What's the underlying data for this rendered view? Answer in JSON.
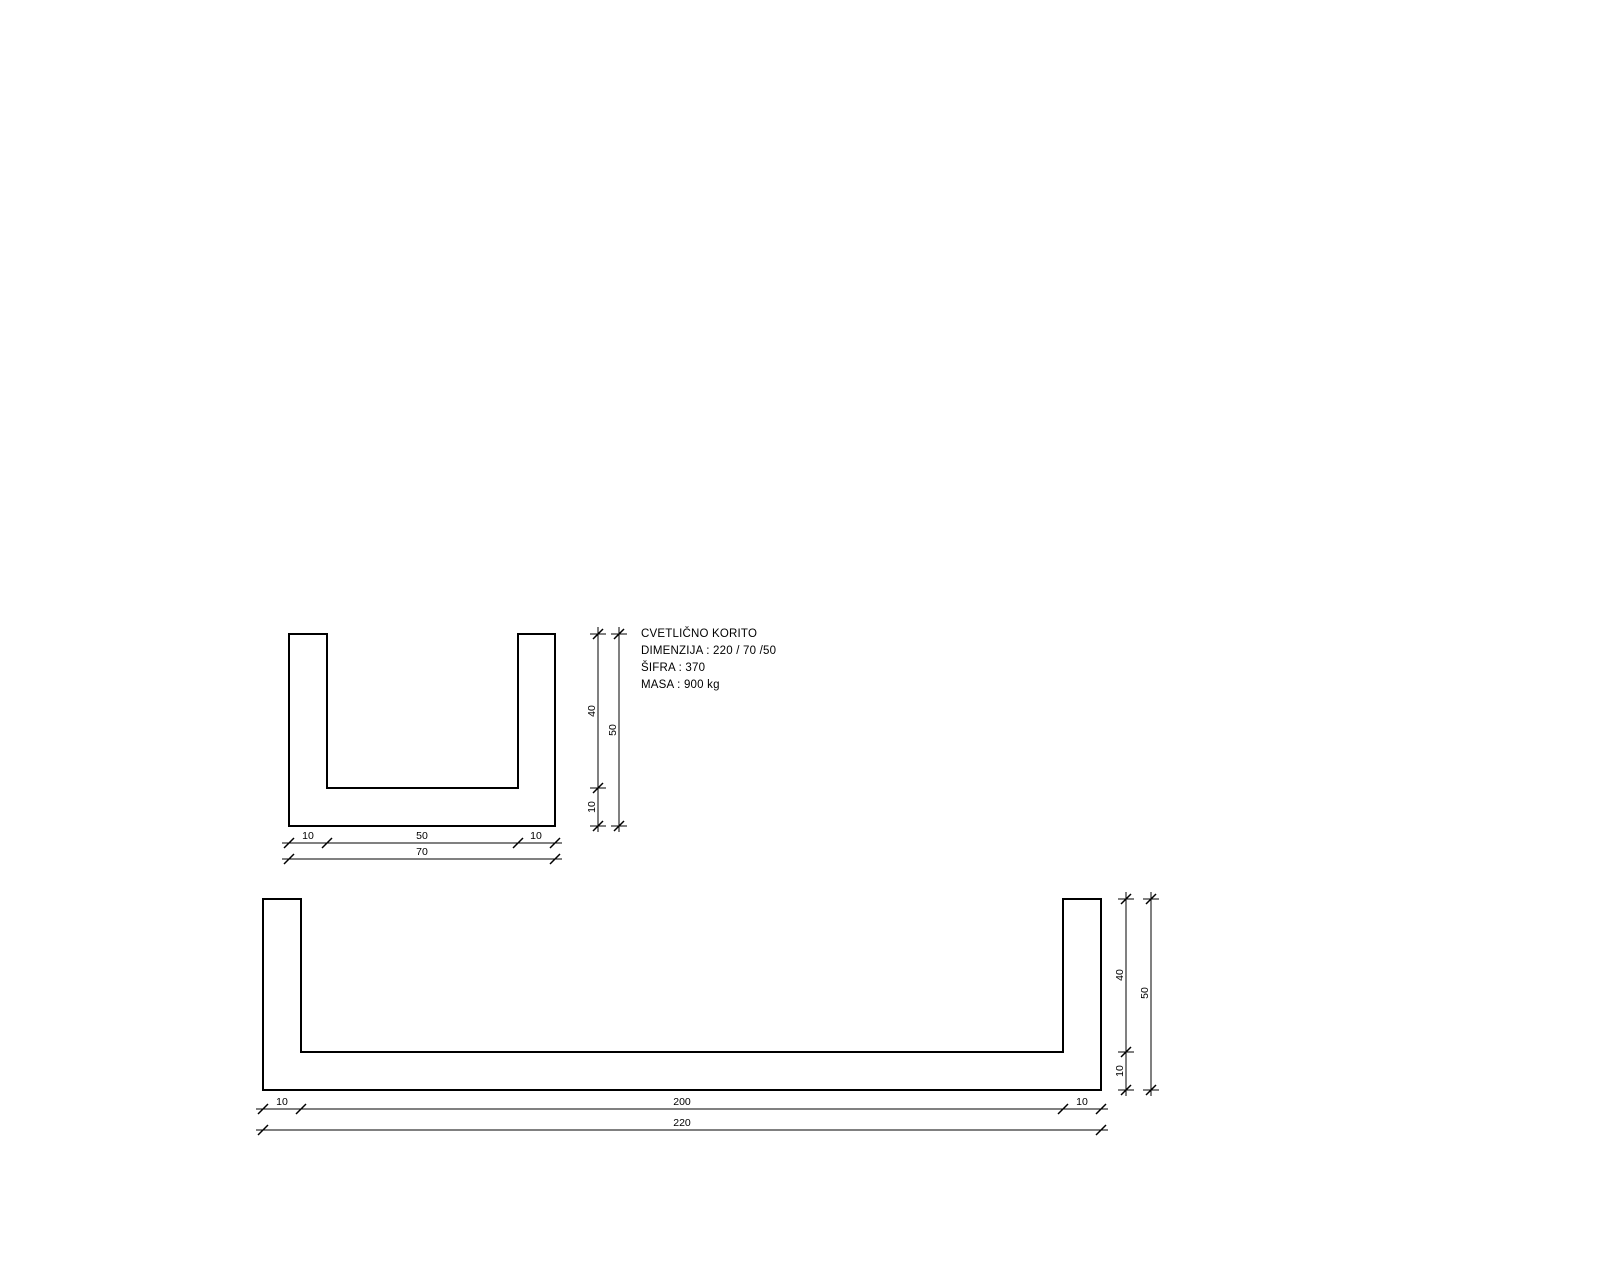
{
  "annotation": {
    "line1": "CVETLIČNO KORITO",
    "line2": "DIMENZIJA : 220 / 70 /50",
    "line3": "ŠIFRA : 370",
    "line4": "MASA : 900 kg"
  },
  "small_section": {
    "bottom_dims": {
      "left_wall": "10",
      "inner": "50",
      "right_wall": "10",
      "total": "70"
    },
    "side_dims": {
      "inner_height": "40",
      "total_height": "50",
      "base": "10"
    }
  },
  "long_section": {
    "bottom_dims": {
      "left_wall": "10",
      "inner": "200",
      "right_wall": "10",
      "total": "220"
    },
    "side_dims": {
      "inner_height": "40",
      "total_height": "50",
      "base": "10"
    }
  },
  "colors": {
    "line": "#000000",
    "background": "#ffffff"
  }
}
